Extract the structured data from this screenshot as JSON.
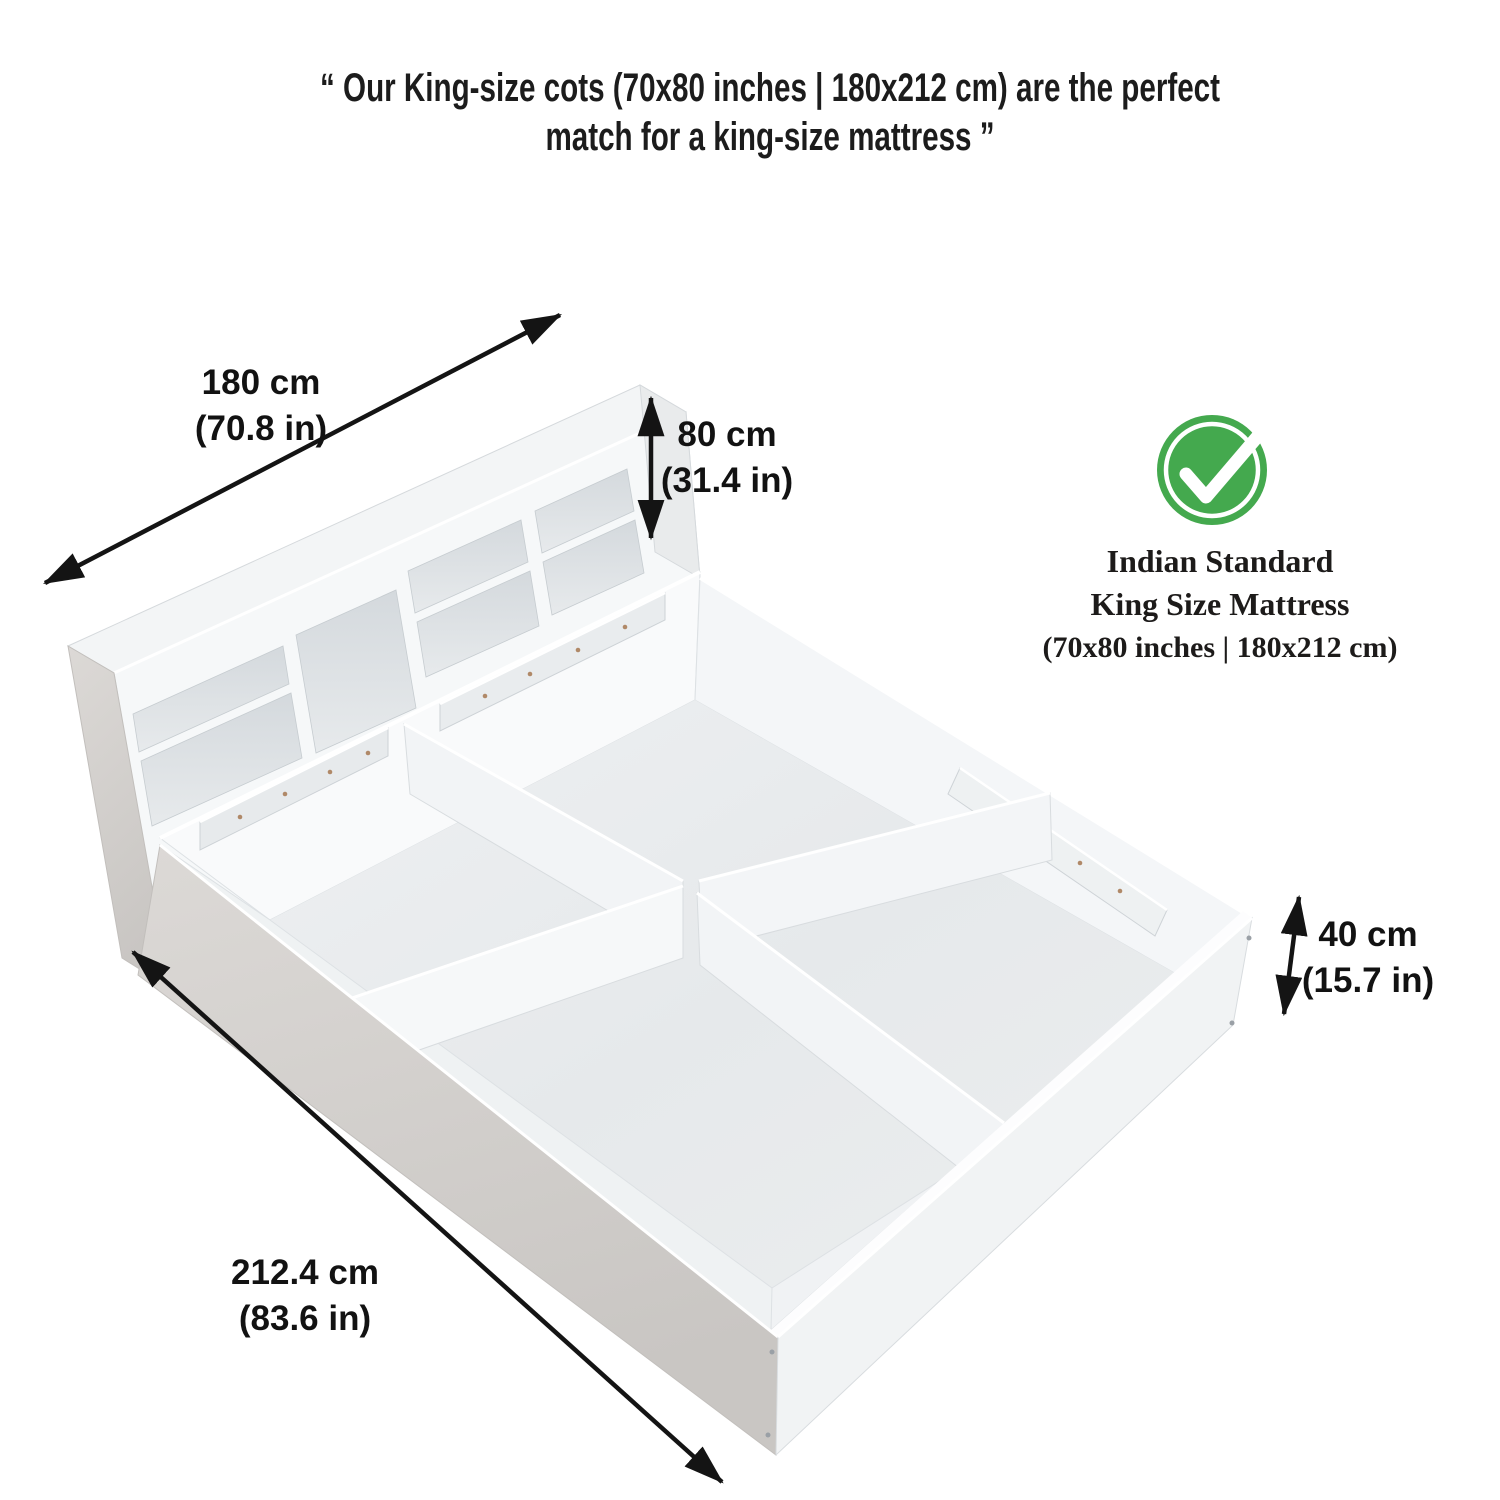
{
  "quote": {
    "line1": "“ Our King-size cots (70x80 inches | 180x212 cm) are the perfect",
    "line2": "match for a king-size mattress ”"
  },
  "dimensions": {
    "width": {
      "cm": "180 cm",
      "inches": "(70.8 in)"
    },
    "headboard_height": {
      "cm": "80 cm",
      "inches": "(31.4 in)"
    },
    "storage_height": {
      "cm": "40 cm",
      "inches": "(15.7 in)"
    },
    "length": {
      "cm": "212.4 cm",
      "inches": "(83.6 in)"
    }
  },
  "badge": {
    "icon": "check-circle-icon",
    "accent_color": "#44a94e",
    "line1": "Indian Standard",
    "line2": "King Size Mattress",
    "line3": "(70x80 inches | 180x212 cm)"
  }
}
